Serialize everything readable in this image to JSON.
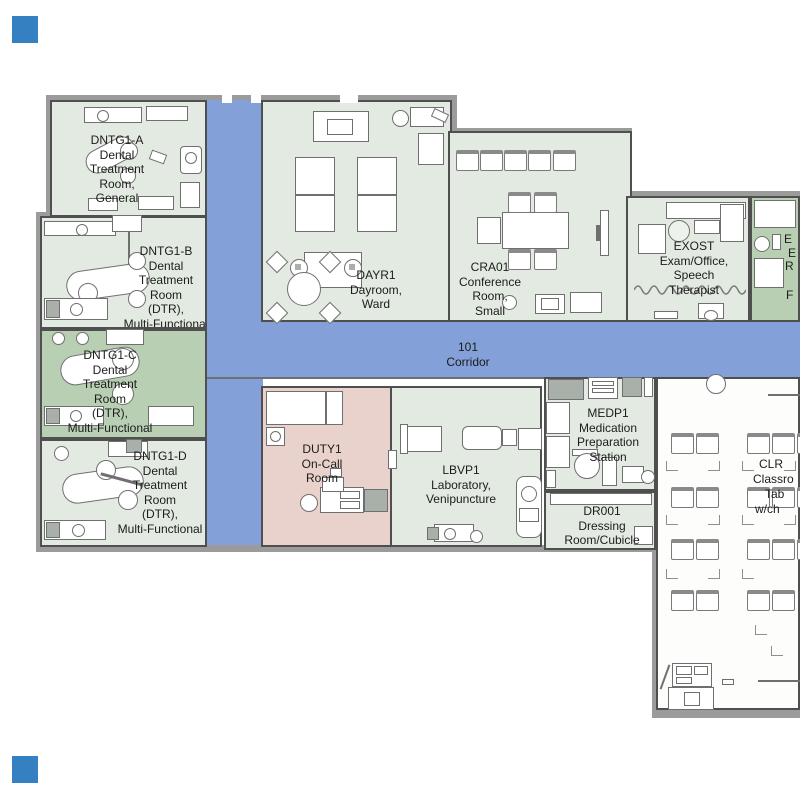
{
  "plan_title": "Dental clinic floor plan",
  "corridor": {
    "code": "101",
    "name": "Corridor",
    "color": "#84a0d8"
  },
  "rooms": {
    "dntg1a": {
      "lines": [
        "DNTG1-A",
        "Dental",
        "Treatment",
        "Room,",
        "General"
      ]
    },
    "dntg1b": {
      "lines": [
        "DNTG1-B",
        "Dental",
        "Treatment",
        "Room",
        "(DTR),",
        "Multi-Functional"
      ]
    },
    "dntg1c": {
      "lines": [
        "DNTG1-C",
        "Dental",
        "Treatment",
        "Room",
        "(DTR),",
        "Multi-Functional"
      ]
    },
    "dntg1d": {
      "lines": [
        "DNTG1-D",
        "Dental",
        "Treatment",
        "Room",
        "(DTR),",
        "Multi-Functional"
      ]
    },
    "dayr1": {
      "lines": [
        "DAYR1",
        "Dayroom,",
        "Ward"
      ]
    },
    "cra01": {
      "lines": [
        "CRA01",
        "Conference",
        "Room,",
        "Small"
      ]
    },
    "exost": {
      "lines": [
        "EXOST",
        "Exam/Office,",
        "Speech",
        "Therapist"
      ]
    },
    "exam_partial": {
      "lines": [
        "E",
        "E",
        "R",
        "F"
      ]
    },
    "duty1": {
      "lines": [
        "DUTY1",
        "On-Call",
        "Room"
      ]
    },
    "lbvp1": {
      "lines": [
        "LBVP1",
        "Laboratory,",
        "Venipuncture"
      ]
    },
    "medp1": {
      "lines": [
        "MEDP1",
        "Medication",
        "Preparation",
        "Station"
      ]
    },
    "dr001": {
      "lines": [
        "DR001",
        "Dressing",
        "Room/Cubicle"
      ]
    },
    "clr_partial": {
      "lines": [
        "CLR",
        "Classro",
        "Tab",
        "w/ch"
      ]
    }
  },
  "icons": [
    "dental-chair",
    "sink-counter",
    "bed",
    "sofa",
    "round-table",
    "conference-table",
    "chair",
    "tv-screen",
    "acoustic-wave",
    "desk",
    "recliner",
    "bench",
    "column"
  ],
  "colors": {
    "corridor_blue": "#84a0d8",
    "room_light_green": "#e3eae1",
    "room_green": "#b9cfb4",
    "room_pink": "#e9d2cb",
    "classroom_white": "#fdfdfc",
    "outer_wall_gray": "#9b9b9b",
    "inner_wall_dark": "#4f4f4f",
    "corner_marker_blue": "#3580c0",
    "text": "#1c1c1c"
  }
}
